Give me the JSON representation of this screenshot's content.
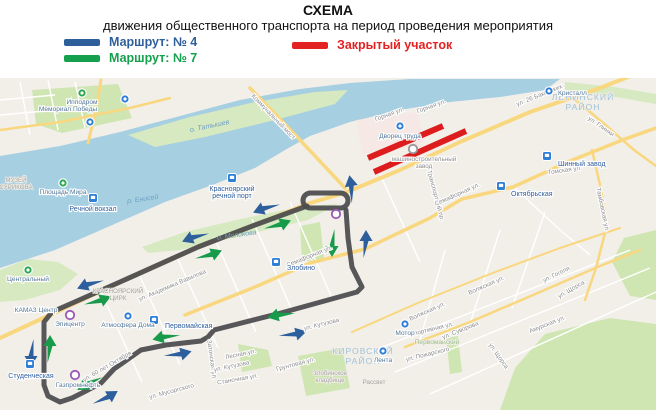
{
  "header": {
    "title": "СХЕМА",
    "subtitle": "движения общественного транспорта на период проведения мероприятия"
  },
  "legend": {
    "items": [
      {
        "id": "route-4",
        "label": "Маршрут: № 4",
        "color": "#2e5f9b"
      },
      {
        "id": "route-7",
        "label": "Маршрут: № 7",
        "color": "#14a04d"
      },
      {
        "id": "closed",
        "label": "Закрытый участок",
        "color": "#e32222"
      }
    ]
  },
  "map": {
    "colors": {
      "land": "#f2efe9",
      "water": "#a6cfe2",
      "island": "#d6e9c0",
      "park": "#cfe6b3",
      "pink": "#f7e6e4",
      "road": "#f9d77f",
      "minor": "#ffffff",
      "route": "#4d4d4f",
      "closed": "#dd1d1d",
      "blue": "#2d5f9c",
      "green": "#189a4b",
      "icon_blue": "#2f7ed8",
      "icon_green": "#2aa852",
      "icon_purple": "#9b59b6",
      "icon_gray": "#9a9a9a"
    },
    "route": {
      "width": 5,
      "points": "307,206 255,225 198,247 120,282 52,312 44,322 44,385 48,396 60,402 72,398 84,392 101,383 114,369 141,350 166,345 201,341 208,337 214,330 281,313 357,292 362,287 352,267 348,238 346,210",
      "loop": {
        "x": 303,
        "y": 193,
        "w": 45,
        "h": 15,
        "r": 7.5
      }
    },
    "closed_section": {
      "width": 6,
      "segments": [
        [
          368,
          158,
          443,
          126
        ],
        [
          374,
          172,
          466,
          131
        ]
      ]
    },
    "arrows": {
      "blue": [
        {
          "x": 267,
          "y": 207,
          "a": 158
        },
        {
          "x": 196,
          "y": 236,
          "a": 158
        },
        {
          "x": 91,
          "y": 283,
          "a": 158
        },
        {
          "x": 352,
          "y": 190,
          "a": -100
        },
        {
          "x": 366,
          "y": 245,
          "a": -90
        },
        {
          "x": 31,
          "y": 352,
          "a": 90
        },
        {
          "x": 105,
          "y": 399,
          "a": -32
        },
        {
          "x": 177,
          "y": 355,
          "a": -14
        },
        {
          "x": 292,
          "y": 335,
          "a": -14
        }
      ],
      "green": [
        {
          "x": 277,
          "y": 226,
          "a": -22
        },
        {
          "x": 208,
          "y": 256,
          "a": -22
        },
        {
          "x": 97,
          "y": 302,
          "a": -22
        },
        {
          "x": 50,
          "y": 350,
          "a": -90
        },
        {
          "x": 332,
          "y": 242,
          "a": 90
        },
        {
          "x": 90,
          "y": 382,
          "a": 148
        },
        {
          "x": 167,
          "y": 336,
          "a": 166
        },
        {
          "x": 282,
          "y": 314,
          "a": 166
        }
      ]
    },
    "districts": [
      {
        "lines": [
          "ЛЕНИНСКИЙ",
          "РАЙОН"
        ],
        "x": 583,
        "y": 100
      },
      {
        "lines": [
          "КИРОВСКИЙ",
          "РАЙОН"
        ],
        "x": 363,
        "y": 354
      }
    ],
    "water_labels": [
      {
        "text": "р. Енисей",
        "x": 143,
        "y": 201,
        "r": -8
      },
      {
        "text": "о. Молокова",
        "x": 237,
        "y": 237,
        "r": -8
      },
      {
        "text": "о. Татышев",
        "x": 210,
        "y": 128,
        "r": -12
      }
    ],
    "stations": [
      {
        "lines": [
          "Речной вокзал"
        ],
        "icon": [
          93,
          198
        ],
        "label": [
          93,
          211
        ],
        "anchor": "middle"
      },
      {
        "lines": [
          "Красноярский",
          "речной порт"
        ],
        "icon": [
          232,
          178
        ],
        "label": [
          232,
          191
        ],
        "anchor": "middle"
      },
      {
        "lines": [
          "Октябрьская"
        ],
        "icon": [
          501,
          186
        ],
        "label": [
          511,
          196
        ],
        "anchor": "start"
      },
      {
        "lines": [
          "Шинный завод"
        ],
        "icon": [
          547,
          156
        ],
        "label": [
          558,
          166
        ],
        "anchor": "start"
      },
      {
        "lines": [
          "Злобино"
        ],
        "icon": [
          276,
          262
        ],
        "label": [
          287,
          270
        ],
        "anchor": "start"
      },
      {
        "lines": [
          "Первомайская"
        ],
        "icon": [
          154,
          320
        ],
        "label": [
          165,
          328
        ],
        "anchor": "start"
      },
      {
        "lines": [
          "Студенческая"
        ],
        "icon": [
          30,
          364
        ],
        "label": [
          31,
          378
        ],
        "anchor": "middle"
      }
    ],
    "pois": [
      {
        "type": "green",
        "icon": [
          82,
          93
        ],
        "label": [
          82,
          104
        ],
        "anchor": "middle",
        "lines": [
          "Ипподром"
        ]
      },
      {
        "type": "green",
        "icon": [
          63,
          183
        ],
        "label": [
          63,
          194
        ],
        "anchor": "middle",
        "lines": [
          "Площадь Мира"
        ]
      },
      {
        "type": "green",
        "icon": [
          28,
          270
        ],
        "label": [
          28,
          281
        ],
        "anchor": "middle",
        "lines": [
          "Центральный"
        ]
      },
      {
        "type": "blue",
        "icon": [
          125,
          99
        ],
        "label": [
          125,
          110
        ],
        "anchor": "middle",
        "lines": []
      },
      {
        "type": "blue",
        "icon": [
          90,
          122
        ],
        "label": [
          90,
          132
        ],
        "anchor": "middle",
        "lines": []
      },
      {
        "type": "blue",
        "icon": [
          400,
          126
        ],
        "label": [
          400,
          138
        ],
        "anchor": "middle",
        "lines": [
          "Дворец труда"
        ]
      },
      {
        "type": "blue",
        "icon": [
          549,
          91
        ],
        "label": [
          558,
          95
        ],
        "anchor": "start",
        "lines": [
          "Кристалл"
        ]
      },
      {
        "type": "blue",
        "icon": [
          405,
          324
        ],
        "label": [
          405,
          335
        ],
        "anchor": "middle",
        "lines": [
          "Мотор"
        ]
      },
      {
        "type": "blue",
        "icon": [
          383,
          351
        ],
        "label": [
          383,
          362
        ],
        "anchor": "middle",
        "lines": [
          "Лента"
        ]
      },
      {
        "type": "blue",
        "icon": [
          128,
          316
        ],
        "label": [
          128,
          327
        ],
        "anchor": "middle",
        "lines": [
          "Атмосфера Дома"
        ]
      },
      {
        "type": "purple",
        "icon": [
          70,
          315
        ],
        "label": [
          70,
          326
        ],
        "anchor": "middle",
        "lines": [
          "Эпицентр"
        ]
      },
      {
        "type": "purple",
        "icon": [
          75,
          375
        ],
        "label": [
          78,
          387
        ],
        "anchor": "middle",
        "lines": [
          "Газпромнефть"
        ]
      },
      {
        "type": "purple",
        "icon": [
          336,
          214
        ],
        "label": [
          336,
          224
        ],
        "anchor": "middle",
        "lines": []
      },
      {
        "type": "gray",
        "icon": [
          413,
          149
        ],
        "label": [
          424,
          161
        ],
        "anchor": "middle",
        "lines": [
          "машиностроительный",
          "завод"
        ]
      },
      {
        "type": "none",
        "icon": [
          0,
          0
        ],
        "label": [
          68,
          111
        ],
        "anchor": "middle",
        "lines": [
          "Мемориал Победы"
        ]
      },
      {
        "type": "none",
        "icon": [
          0,
          0
        ],
        "label": [
          36,
          312
        ],
        "anchor": "middle",
        "lines": [
          "КАМАЗ Центр"
        ]
      }
    ],
    "streets": [
      {
        "t": "Коммунальный мост",
        "x": 272,
        "y": 118,
        "r": 46
      },
      {
        "t": "Горная ул.",
        "x": 390,
        "y": 116,
        "r": -20
      },
      {
        "t": "Горная ул.",
        "x": 432,
        "y": 108,
        "r": -20
      },
      {
        "t": "ул. 26 Бакинских",
        "x": 540,
        "y": 97,
        "r": -22
      },
      {
        "t": "ул. Глинки",
        "x": 600,
        "y": 128,
        "r": 35
      },
      {
        "t": "Томская ул.",
        "x": 565,
        "y": 172,
        "r": -8
      },
      {
        "t": "Тамбовская ул.",
        "x": 601,
        "y": 210,
        "r": 78
      },
      {
        "t": "Транспортный пр.",
        "x": 434,
        "y": 196,
        "r": 75
      },
      {
        "t": "Семафорная ул.",
        "x": 458,
        "y": 196,
        "r": -24
      },
      {
        "t": "Семафорная ул.",
        "x": 310,
        "y": 258,
        "r": -22
      },
      {
        "t": "ул. Академика Вавилова",
        "x": 173,
        "y": 287,
        "r": -23
      },
      {
        "t": "ул. 60 лет Октября",
        "x": 108,
        "y": 368,
        "r": -30
      },
      {
        "t": "ул. Мусоргского",
        "x": 172,
        "y": 393,
        "r": -15
      },
      {
        "t": "Затонская ул.",
        "x": 210,
        "y": 360,
        "r": 82
      },
      {
        "t": "ул. Кутузова",
        "x": 322,
        "y": 326,
        "r": -14
      },
      {
        "t": "Лесная ул.",
        "x": 241,
        "y": 356,
        "r": -12
      },
      {
        "t": "ул. Кутузова",
        "x": 232,
        "y": 368,
        "r": -12
      },
      {
        "t": "Станочная ул.",
        "x": 238,
        "y": 381,
        "r": -10
      },
      {
        "t": "Грунтовая ул.",
        "x": 296,
        "y": 366,
        "r": -15
      },
      {
        "t": "Волжская ул.",
        "x": 487,
        "y": 287,
        "r": -24
      },
      {
        "t": "Волжская ул.",
        "x": 428,
        "y": 313,
        "r": -24
      },
      {
        "t": "ул. Гоголя",
        "x": 557,
        "y": 276,
        "r": -26
      },
      {
        "t": "ул. Щорса",
        "x": 572,
        "y": 291,
        "r": -30
      },
      {
        "t": "Амурская ул.",
        "x": 548,
        "y": 326,
        "r": -22
      },
      {
        "t": "Спортивная ул.",
        "x": 432,
        "y": 331,
        "r": -14
      },
      {
        "t": "ул. Суворова",
        "x": 461,
        "y": 332,
        "r": -22
      },
      {
        "t": "ул. Пожарского",
        "x": 428,
        "y": 356,
        "r": -14
      },
      {
        "t": "ул. Щорса",
        "x": 497,
        "y": 357,
        "r": 55
      }
    ],
    "area_labels": [
      {
        "lines": [
          "КРАСНОЯРСКИЙ",
          "ЦИРК"
        ],
        "x": 118,
        "y": 293,
        "cls": "area-gray"
      },
      {
        "lines": [
          "МУЗЕЙ",
          "СУРИКОВА"
        ],
        "x": 16,
        "y": 182,
        "cls": "area-gray"
      },
      {
        "lines": [
          "Первомайский"
        ],
        "x": 437,
        "y": 344,
        "cls": "area-green"
      },
      {
        "lines": [
          "Злобинское",
          "кладбище"
        ],
        "x": 330,
        "y": 375,
        "cls": "area-gray"
      },
      {
        "lines": [
          "Рассвет"
        ],
        "x": 374,
        "y": 384,
        "cls": "area-gray"
      }
    ]
  }
}
